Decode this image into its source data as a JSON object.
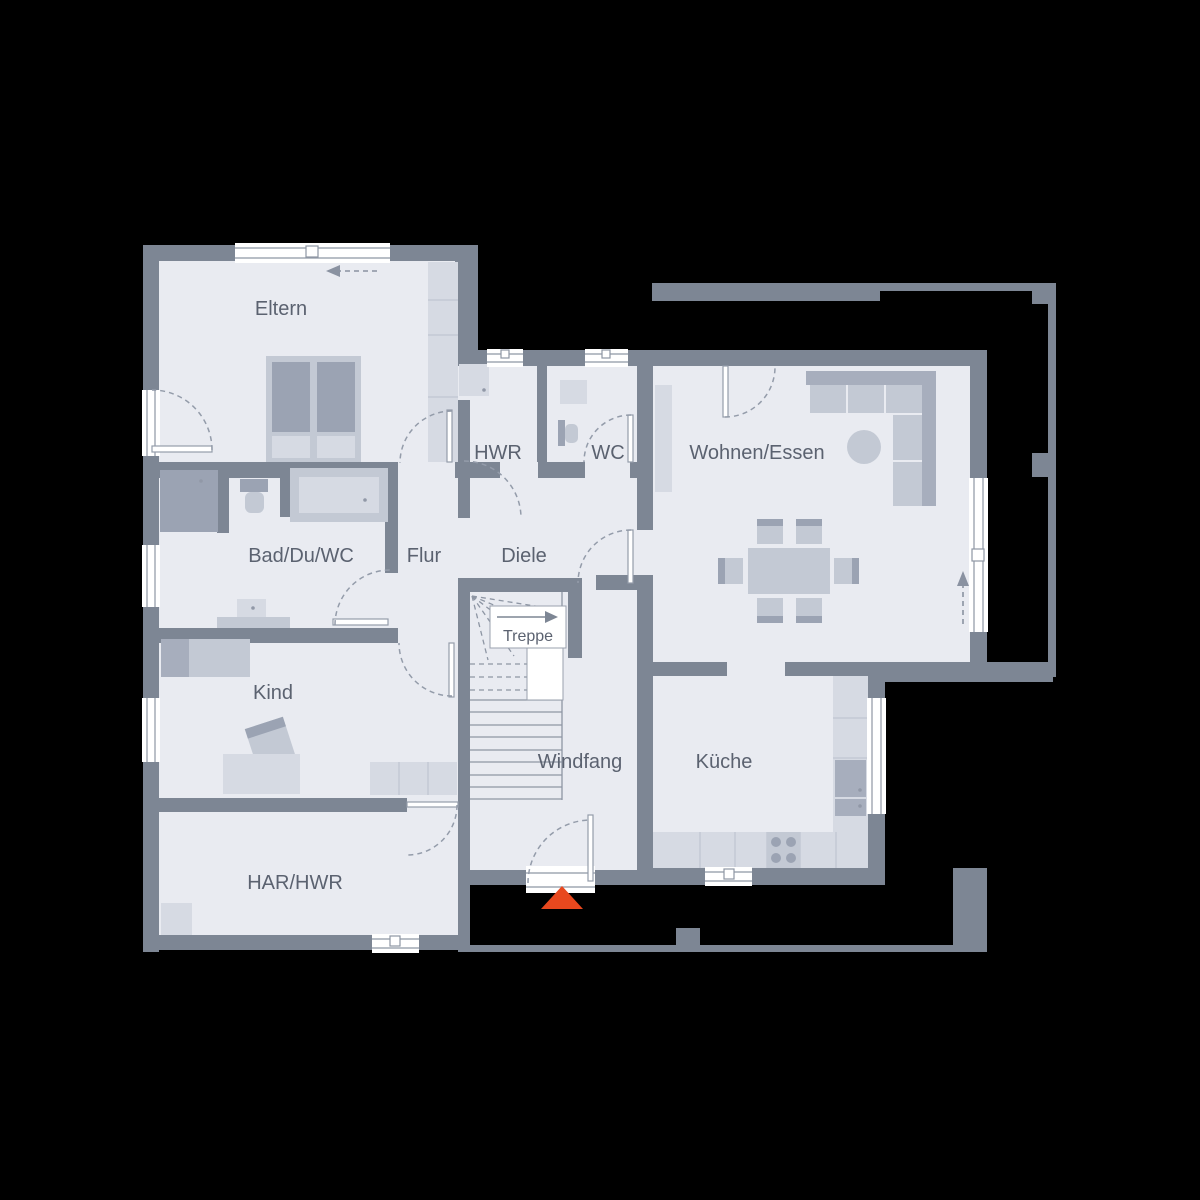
{
  "plan_type": "floor-plan",
  "rooms": {
    "eltern": "Eltern",
    "hwr": "HWR",
    "wc": "WC",
    "wohnen_essen": "Wohnen/Essen",
    "bad_du_wc": "Bad/Du/WC",
    "flur": "Flur",
    "diele": "Diele",
    "treppe": "Treppe",
    "kind": "Kind",
    "windfang": "Windfang",
    "kueche": "Küche",
    "har_hwr": "HAR/HWR"
  },
  "colors": {
    "background": "#000000",
    "wall": "#7d8694",
    "floor": "#e9ebf1",
    "furniture_light": "#d6dae3",
    "furniture_mid": "#c3c9d4",
    "furniture_dark": "#a7aebd",
    "stair_line": "#8e96a4",
    "label_text": "#5b6270",
    "entrance_marker": "#e8481e",
    "window": "#ffffff"
  }
}
